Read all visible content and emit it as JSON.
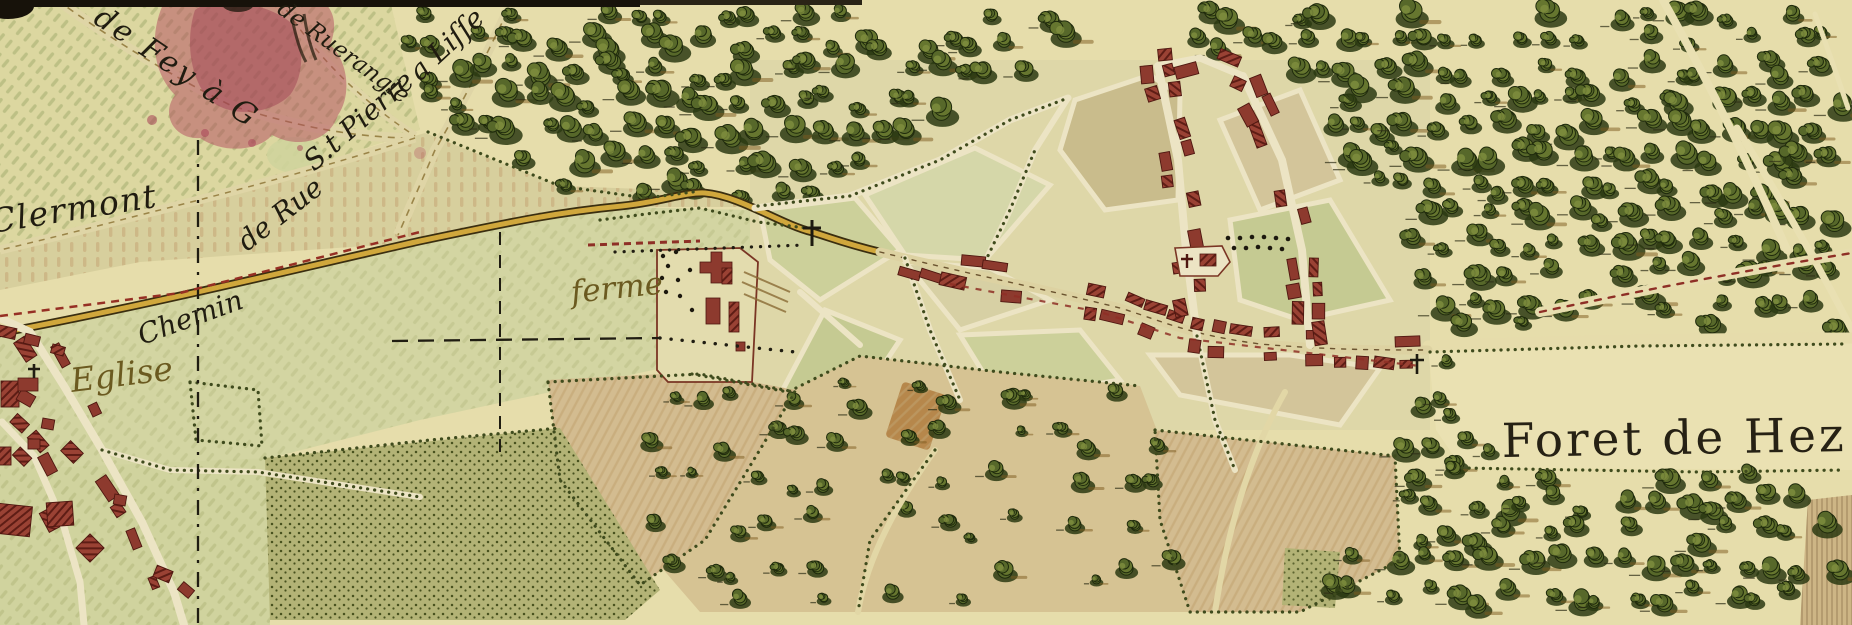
{
  "map": {
    "labels": {
      "clermont": "Clermont",
      "chemin": "Chemin",
      "de_rue": "de Rue",
      "st_pierre": "S.t Pierre",
      "a_lisse": "a Liſſe",
      "de_fey": "de Fey à G",
      "de_ruerangle": "de Ruerangle",
      "eglise": "Eglise",
      "ferme": "ferme",
      "foret_de_hez": "Foret de Hez"
    },
    "colors": {
      "parchment": "#e6ddab",
      "field_green": "#d3d5a2",
      "forest_green": "#5c6e2e",
      "road_yellow": "#d0a73c",
      "building_red": "#8d3a2e",
      "stain_red": "#b14a5e",
      "ink_black": "#201d12",
      "handwriting_brown": "#6b5a20"
    }
  }
}
